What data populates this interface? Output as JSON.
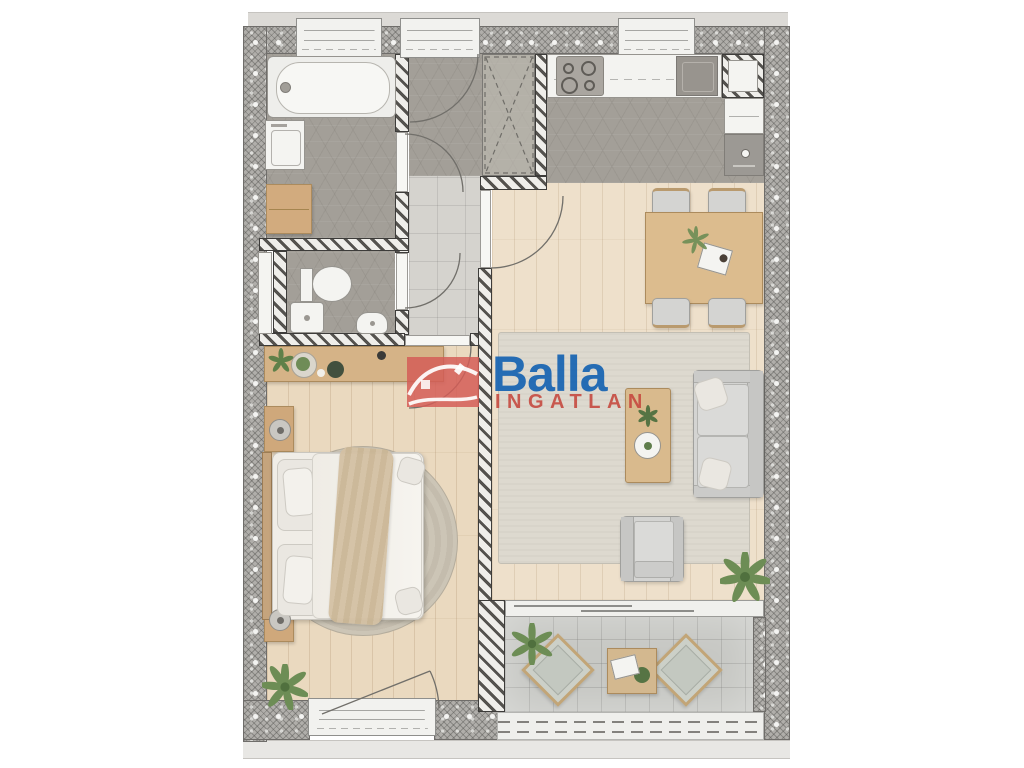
{
  "watermark": {
    "brand": "Balla",
    "subtitle": "INGATLAN",
    "brand_color": "#1763b2",
    "subtitle_color": "#c5493f",
    "icon": "house-logo-icon",
    "icon_bg": "#d45c56"
  },
  "palette": {
    "background": "#ffffff",
    "exterior_wall": "#b0aeaa",
    "interior_wall_hatch": "#54524e",
    "gray_hex_tile": "#a39f98",
    "light_tile": "#d5d3ce",
    "wood_floor": "#ead9bf",
    "wood_furniture": "#d7b88c",
    "upholstery": "#d4d4d2",
    "living_rug": "#ddd9cf",
    "bedroom_rug": "#ccc5b6",
    "balcony_tile": "#c7c8c4",
    "plant_green": "#6d8d55"
  },
  "floorplan": {
    "rooms": [
      {
        "name": "bathroom",
        "floor": "gray-hex-tile",
        "items": [
          "bathtub",
          "washing-machine",
          "wood-cabinet",
          "window"
        ]
      },
      {
        "name": "toilet",
        "floor": "gray-hex-tile",
        "items": [
          "wc-toilet",
          "shower-tray",
          "corner-washbasin",
          "duct-panel",
          "door"
        ]
      },
      {
        "name": "hallway",
        "floor": "gray-hex-tile-and-light-tile",
        "items": [
          "entry-door",
          "built-in-wardrobe",
          "door-to-bathroom",
          "door-to-toilet",
          "door-to-bedroom",
          "door-to-living-room"
        ]
      },
      {
        "name": "kitchen",
        "floor": "gray-hex-tile",
        "items": [
          "counter",
          "cooktop",
          "sink",
          "shaft",
          "tall-cabinet",
          "oven",
          "window"
        ]
      },
      {
        "name": "living-room",
        "floor": "wood",
        "items": [
          "dining-table",
          "dining-chair",
          "dining-chair",
          "dining-chair",
          "dining-chair",
          "area-rug",
          "coffee-table",
          "sofa",
          "armchair",
          "plant",
          "sliding-door"
        ]
      },
      {
        "name": "bedroom",
        "floor": "wood",
        "items": [
          "console-desk",
          "double-bed",
          "round-rug",
          "nightstand",
          "nightstand",
          "plant",
          "french-door"
        ]
      },
      {
        "name": "balcony",
        "floor": "tile",
        "items": [
          "lounge-chair",
          "lounge-chair",
          "side-table",
          "plant",
          "railing"
        ]
      }
    ]
  }
}
